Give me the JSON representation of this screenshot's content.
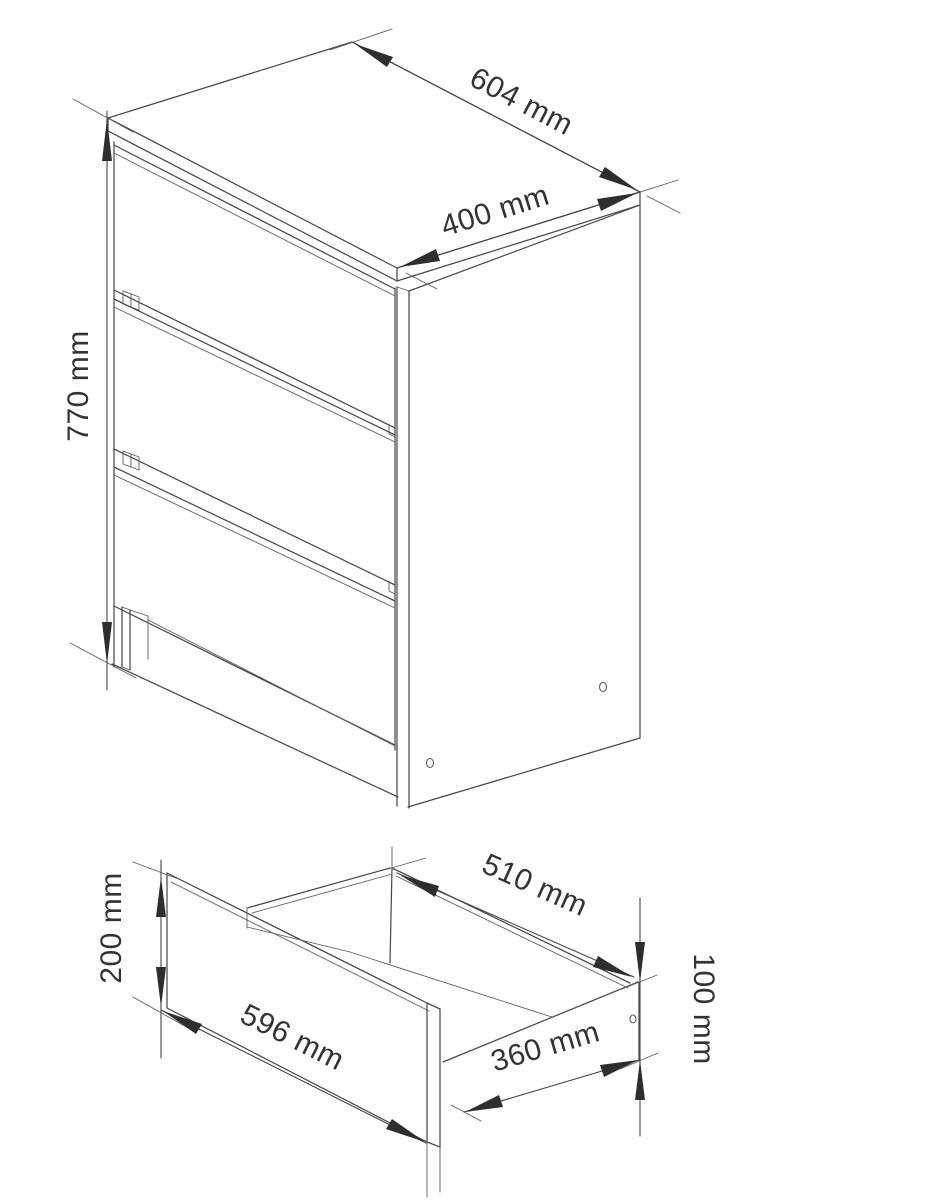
{
  "page": {
    "background": "#ffffff",
    "line_color": "#4a4a4a",
    "arrow_color": "#2e2e2e",
    "text_color": "#333333"
  },
  "drawing": {
    "type": "furniture-technical-drawing",
    "subject": "three-drawer chest with detached drawer detail",
    "views": {
      "cabinet": {
        "name": "cabinet isometric view",
        "drawer_count": 3,
        "screw_hole_count": 2,
        "dimensions": {
          "depth": {
            "label": "604 mm",
            "value": 604,
            "unit": "mm"
          },
          "width": {
            "label": "400 mm",
            "value": 400,
            "unit": "mm"
          },
          "height": {
            "label": "770 mm",
            "value": 770,
            "unit": "mm"
          }
        }
      },
      "drawer": {
        "name": "drawer isometric detail view",
        "screw_hole_count": 1,
        "dimensions": {
          "front_height": {
            "label": "200 mm",
            "value": 200,
            "unit": "mm"
          },
          "front_width": {
            "label": "596 mm",
            "value": 596,
            "unit": "mm"
          },
          "depth": {
            "label": "510 mm",
            "value": 510,
            "unit": "mm"
          },
          "bottom_width": {
            "label": "360 mm",
            "value": 360,
            "unit": "mm"
          },
          "side_height": {
            "label": "100 mm",
            "value": 100,
            "unit": "mm"
          }
        }
      }
    }
  }
}
